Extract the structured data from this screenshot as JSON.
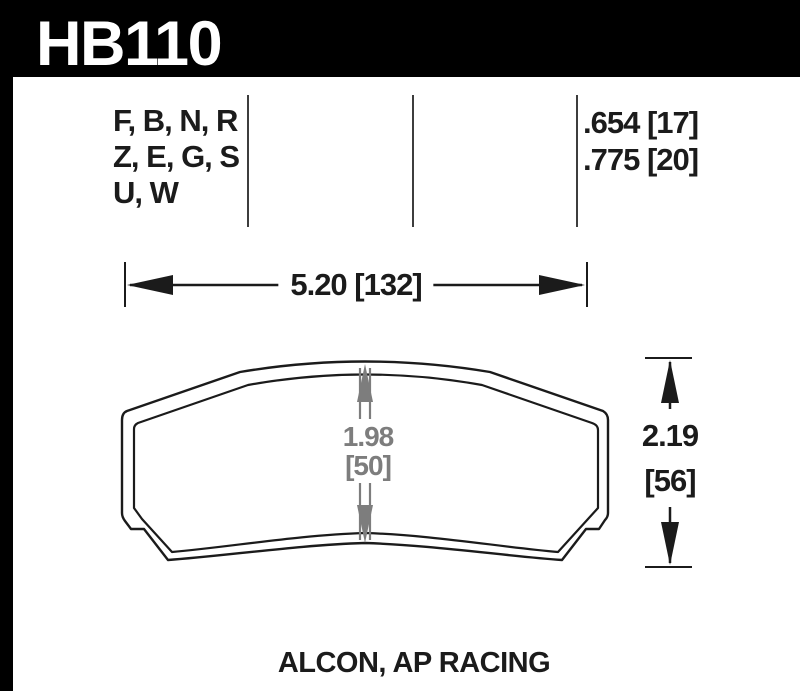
{
  "header": {
    "part_number": "HB110",
    "background": "#000000",
    "text_color": "#ffffff"
  },
  "spec_table": {
    "compound_rows": [
      "F, B, N, R",
      "Z, E, G, S",
      "U, W"
    ],
    "thickness_rows": [
      ".654 [17]",
      ".775 [20]"
    ]
  },
  "dimensions": {
    "overall_width": "5.20 [132]",
    "overall_height_in": "2.19",
    "overall_height_mm": "[56]",
    "pad_height_in": "1.98",
    "pad_height_mm": "[50]"
  },
  "footer": {
    "applications": "ALCON, AP RACING"
  },
  "colors": {
    "ink": "#1b1b1b",
    "dim_gray": "#7d7d7d",
    "divider": "#3d3d3d",
    "page_background": "#ffffff"
  }
}
